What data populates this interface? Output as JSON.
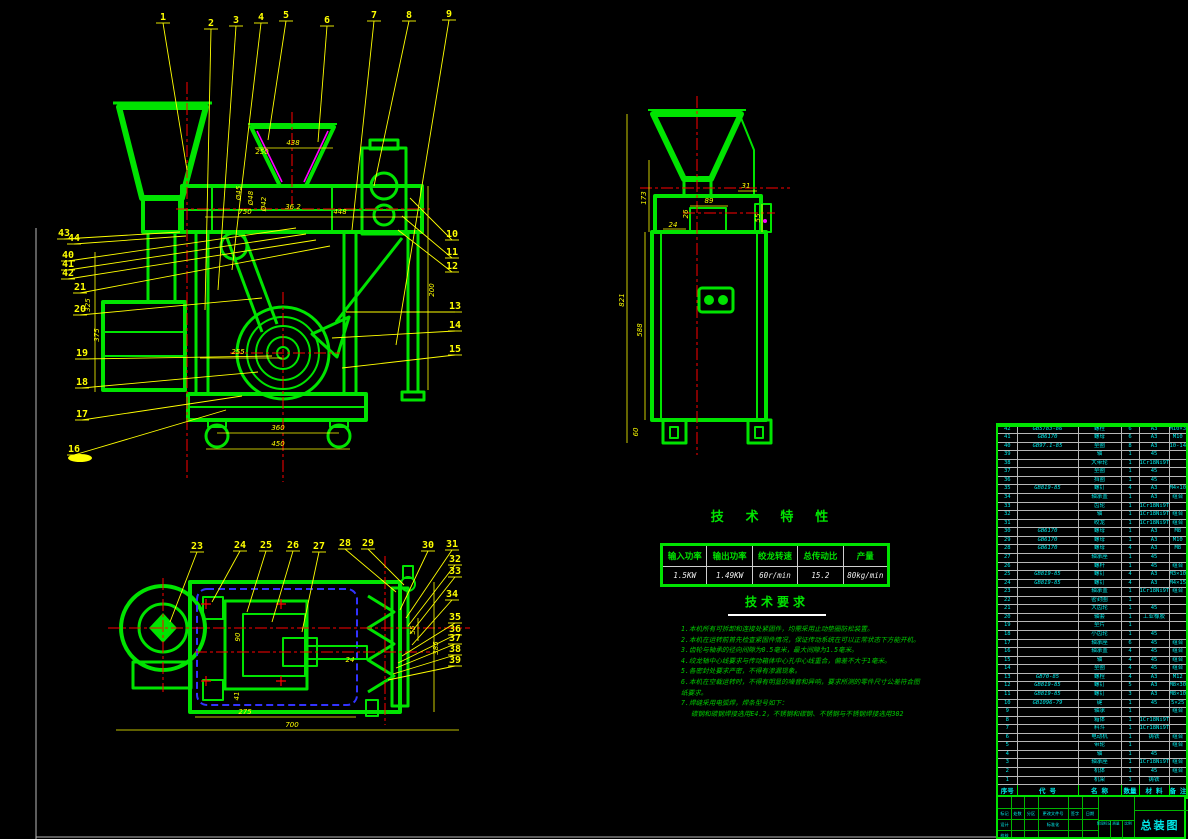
{
  "colors": {
    "line_green": "#00e400",
    "dim_yellow": "#ffff00",
    "center_red": "#ff0000",
    "hidden_blue": "#3333ff",
    "accent_magenta": "#ff00ff",
    "text_cyan": "#00e8e8",
    "grid_white": "#cfcfcf"
  },
  "drawing": {
    "callouts": [
      {
        "n": "1",
        "x": 163,
        "y": 20,
        "tx": 187,
        "ty": 170
      },
      {
        "n": "2",
        "x": 211,
        "y": 26,
        "tx": 205,
        "ty": 310
      },
      {
        "n": "3",
        "x": 236,
        "y": 23,
        "tx": 218,
        "ty": 290
      },
      {
        "n": "4",
        "x": 261,
        "y": 20,
        "tx": 232,
        "ty": 270
      },
      {
        "n": "5",
        "x": 286,
        "y": 18,
        "tx": 268,
        "ty": 140
      },
      {
        "n": "6",
        "x": 327,
        "y": 23,
        "tx": 318,
        "ty": 142
      },
      {
        "n": "7",
        "x": 374,
        "y": 18,
        "tx": 352,
        "ty": 230
      },
      {
        "n": "8",
        "x": 409,
        "y": 18,
        "tx": 374,
        "ty": 186
      },
      {
        "n": "9",
        "x": 449,
        "y": 17,
        "tx": 396,
        "ty": 345
      },
      {
        "n": "10",
        "x": 452,
        "y": 237,
        "tx": 410,
        "ty": 198
      },
      {
        "n": "11",
        "x": 452,
        "y": 255,
        "tx": 402,
        "ty": 216
      },
      {
        "n": "12",
        "x": 452,
        "y": 269,
        "tx": 398,
        "ty": 230
      },
      {
        "n": "13",
        "x": 455,
        "y": 309,
        "tx": 346,
        "ty": 312
      },
      {
        "n": "14",
        "x": 455,
        "y": 328,
        "tx": 332,
        "ty": 338
      },
      {
        "n": "15",
        "x": 455,
        "y": 352,
        "tx": 342,
        "ty": 368
      },
      {
        "n": "16",
        "x": 74,
        "y": 452,
        "tx": 226,
        "ty": 410
      },
      {
        "n": "17",
        "x": 82,
        "y": 417,
        "tx": 242,
        "ty": 396
      },
      {
        "n": "18",
        "x": 82,
        "y": 385,
        "tx": 258,
        "ty": 372
      },
      {
        "n": "19",
        "x": 82,
        "y": 356,
        "tx": 272,
        "ty": 356
      },
      {
        "n": "20",
        "x": 80,
        "y": 312,
        "tx": 262,
        "ty": 298
      },
      {
        "n": "21",
        "x": 80,
        "y": 290,
        "tx": 330,
        "ty": 246
      },
      {
        "n": "40",
        "x": 68,
        "y": 258,
        "tx": 296,
        "ty": 228
      },
      {
        "n": "41",
        "x": 68,
        "y": 267,
        "tx": 306,
        "ty": 234
      },
      {
        "n": "42",
        "x": 68,
        "y": 276,
        "tx": 316,
        "ty": 240
      },
      {
        "n": "43",
        "x": 64,
        "y": 236,
        "tx": 180,
        "ty": 232
      },
      {
        "n": "44",
        "x": 74,
        "y": 241,
        "tx": 186,
        "ty": 236
      },
      {
        "n": "23",
        "x": 197,
        "y": 549,
        "tx": 170,
        "ty": 622
      },
      {
        "n": "24",
        "x": 240,
        "y": 548,
        "tx": 212,
        "ty": 602
      },
      {
        "n": "25",
        "x": 266,
        "y": 548,
        "tx": 247,
        "ty": 612
      },
      {
        "n": "26",
        "x": 293,
        "y": 548,
        "tx": 272,
        "ty": 622
      },
      {
        "n": "27",
        "x": 319,
        "y": 549,
        "tx": 302,
        "ty": 632
      },
      {
        "n": "28",
        "x": 345,
        "y": 546,
        "tx": 396,
        "ty": 592
      },
      {
        "n": "29",
        "x": 368,
        "y": 546,
        "tx": 404,
        "ty": 585
      },
      {
        "n": "30",
        "x": 428,
        "y": 548,
        "tx": 400,
        "ty": 610
      },
      {
        "n": "31",
        "x": 452,
        "y": 547,
        "tx": 406,
        "ty": 618
      },
      {
        "n": "32",
        "x": 455,
        "y": 562,
        "tx": 408,
        "ty": 626
      },
      {
        "n": "33",
        "x": 455,
        "y": 574,
        "tx": 410,
        "ty": 634
      },
      {
        "n": "34",
        "x": 452,
        "y": 597,
        "tx": 412,
        "ty": 645
      },
      {
        "n": "35",
        "x": 455,
        "y": 620,
        "tx": 402,
        "ty": 656
      },
      {
        "n": "36",
        "x": 455,
        "y": 632,
        "tx": 398,
        "ty": 663
      },
      {
        "n": "37",
        "x": 455,
        "y": 641,
        "tx": 396,
        "ty": 668
      },
      {
        "n": "38",
        "x": 455,
        "y": 652,
        "tx": 393,
        "ty": 674
      },
      {
        "n": "39",
        "x": 455,
        "y": 663,
        "tx": 388,
        "ty": 680
      }
    ],
    "dims": {
      "front": [
        {
          "t": "438",
          "x": 293,
          "y": 145
        },
        {
          "t": "250",
          "x": 262,
          "y": 154
        },
        {
          "t": "750",
          "x": 245,
          "y": 214
        },
        {
          "t": "36.2",
          "x": 293,
          "y": 209
        },
        {
          "t": "448",
          "x": 340,
          "y": 214
        },
        {
          "t": "200",
          "x": 434,
          "y": 290,
          "r": 1
        },
        {
          "t": "255",
          "x": 238,
          "y": 354
        },
        {
          "t": "360",
          "x": 278,
          "y": 430
        },
        {
          "t": "450",
          "x": 278,
          "y": 446
        },
        {
          "t": "325",
          "x": 90,
          "y": 305,
          "r": 1
        },
        {
          "t": "375",
          "x": 99,
          "y": 335,
          "r": 1
        },
        {
          "t": "Ø45",
          "x": 241,
          "y": 193,
          "r": 1
        },
        {
          "t": "Ø48",
          "x": 253,
          "y": 198,
          "r": 1
        },
        {
          "t": "Ø42",
          "x": 266,
          "y": 204,
          "r": 1
        }
      ],
      "side": [
        {
          "t": "821",
          "x": 624,
          "y": 300,
          "r": 1
        },
        {
          "t": "588",
          "x": 642,
          "y": 330,
          "r": 1
        },
        {
          "t": "173",
          "x": 646,
          "y": 198,
          "r": 1
        },
        {
          "t": "60",
          "x": 638,
          "y": 432,
          "r": 1
        },
        {
          "t": "89",
          "x": 709,
          "y": 203
        },
        {
          "t": "31",
          "x": 746,
          "y": 188
        },
        {
          "t": "24",
          "x": 673,
          "y": 227
        },
        {
          "t": "55",
          "x": 760,
          "y": 218,
          "r": 1
        },
        {
          "t": "26",
          "x": 688,
          "y": 214,
          "r": 1
        }
      ],
      "top": [
        {
          "t": "275",
          "x": 245,
          "y": 714
        },
        {
          "t": "700",
          "x": 292,
          "y": 727
        },
        {
          "t": "385",
          "x": 438,
          "y": 648,
          "r": 1
        },
        {
          "t": "55",
          "x": 415,
          "y": 630,
          "r": 1
        },
        {
          "t": "90",
          "x": 240,
          "y": 637,
          "r": 1
        },
        {
          "t": "41",
          "x": 239,
          "y": 696,
          "r": 1
        },
        {
          "t": "24",
          "x": 350,
          "y": 662
        }
      ]
    }
  },
  "tech_table": {
    "title": "技 术 特 性",
    "headers": [
      "输入功率",
      "输出功率",
      "绞龙转速",
      "总传动比",
      "产量"
    ],
    "values": [
      "1.5KW",
      "1.49KW",
      "60r/min",
      "15.2",
      "80kg/min"
    ]
  },
  "tech_requirements": {
    "title": "技术要求",
    "lines": [
      "1.本机所有可拆卸和连接处紧固件，均需采用止动垫圈防松装置。",
      "2.本机在运转前首先检查紧固件情况，保证传动系统在可以正常状态下方能开机。",
      "3.齿轮与轴承的径向间隙为0.5毫米，最大间隙为1.5毫米。",
      "4.绞龙轴中心线要求与传动箱体中心孔中心线重合，偏差不大于1毫米。",
      "5.各密封处要求严密，不得有渗漏现象。",
      "6.本机在空载运转时，不得有明显的噪音和异响，要求所测的零件尺寸公差符合图纸要求。",
      "7.焊缝采用电弧焊，焊条型号如下：",
      "碳钢和碳钢焊接选用E4.2，不锈钢和碳钢、不锈钢与不锈钢焊接选用302"
    ]
  },
  "bom": {
    "headers": [
      "序号",
      "代 号",
      "名 称",
      "数量",
      "材 料",
      "备 注"
    ],
    "rows": [
      [
        "42",
        "GB5783-86",
        "螺栓",
        "6",
        "A3",
        "M10×30"
      ],
      [
        "41",
        "GB6170",
        "螺母",
        "6",
        "A3",
        "M10"
      ],
      [
        "40",
        "GB97.1-85",
        "垫圈",
        "8",
        "A3",
        "10-140HV"
      ],
      [
        "39",
        "",
        "轴",
        "1",
        "45",
        ""
      ],
      [
        "38",
        "",
        "大带轮",
        "1",
        "1Cr18Ni9Ti",
        ""
      ],
      [
        "37",
        "",
        "垫圈",
        "1",
        "45",
        ""
      ],
      [
        "36",
        "",
        "挡圈",
        "1",
        "45",
        ""
      ],
      [
        "35",
        "GB819-85",
        "螺钉",
        "4",
        "A3",
        "M4×10"
      ],
      [
        "34",
        "",
        "轴承盖",
        "1",
        "A3",
        "组合"
      ],
      [
        "33",
        "",
        "齿轮",
        "1",
        "1Cr18Ni9Ti",
        ""
      ],
      [
        "32",
        "",
        "轴",
        "1",
        "1Cr18Ni9Ti",
        "组合"
      ],
      [
        "31",
        "",
        "绞龙",
        "1",
        "1Cr18Ni9Ti",
        "组合"
      ],
      [
        "30",
        "GB6170",
        "螺母",
        "1",
        "A3",
        "M8"
      ],
      [
        "29",
        "GB6170",
        "螺母",
        "1",
        "A3",
        "M10"
      ],
      [
        "28",
        "GB6170",
        "螺母",
        "4",
        "A3",
        "M8"
      ],
      [
        "27",
        "",
        "轴承座",
        "1",
        "45",
        ""
      ],
      [
        "26",
        "",
        "螺杆",
        "1",
        "45",
        "组合"
      ],
      [
        "25",
        "GB819-85",
        "螺钉",
        "4",
        "A3",
        "M3×10"
      ],
      [
        "24",
        "GB819-85",
        "螺钉",
        "4",
        "A3",
        "M4×15"
      ],
      [
        "23",
        "",
        "轴承盖",
        "1",
        "1Cr18Ni9Ti",
        "组合"
      ],
      [
        "22",
        "",
        "密封圈",
        "1",
        "",
        ""
      ],
      [
        "21",
        "",
        "大齿轮",
        "1",
        "45",
        ""
      ],
      [
        "20",
        "",
        "轴套",
        "1",
        "工业橡胶",
        ""
      ],
      [
        "19",
        "",
        "垫片",
        "1",
        "",
        ""
      ],
      [
        "18",
        "",
        "小齿轮",
        "1",
        "45",
        ""
      ],
      [
        "17",
        "",
        "轴承座",
        "6",
        "45",
        "组合"
      ],
      [
        "16",
        "",
        "轴承盖",
        "4",
        "45",
        "组合"
      ],
      [
        "15",
        "",
        "轴",
        "4",
        "45",
        "组合"
      ],
      [
        "14",
        "",
        "垫圈",
        "4",
        "45",
        "组合"
      ],
      [
        "13",
        "GB70-85",
        "螺栓",
        "4",
        "A3",
        "M12"
      ],
      [
        "12",
        "GB819-85",
        "螺钉",
        "5",
        "A3",
        "M8×30"
      ],
      [
        "11",
        "GB819-85",
        "螺钉",
        "3",
        "A3",
        "M8×10"
      ],
      [
        "10",
        "GB1096-79",
        "键",
        "1",
        "45",
        "5×25"
      ],
      [
        "9",
        "",
        "轴承",
        "1",
        "",
        "组合"
      ],
      [
        "8",
        "",
        "箱体",
        "1",
        "1Cr18Ni9Ti",
        ""
      ],
      [
        "7",
        "",
        "料斗",
        "1",
        "1Cr18Ni9Ti",
        ""
      ],
      [
        "6",
        "",
        "电动机",
        "1",
        "铸铁",
        "组合"
      ],
      [
        "5",
        "",
        "带轮",
        "1",
        "",
        "组合"
      ],
      [
        "4",
        "",
        "轴",
        "1",
        "45",
        ""
      ],
      [
        "3",
        "",
        "轴承座",
        "1",
        "1Cr18Ni9Ti",
        "组合"
      ],
      [
        "2",
        "",
        "机体",
        "1",
        "45",
        "组合"
      ],
      [
        "1",
        "",
        "机架",
        "1",
        "铸铁",
        ""
      ]
    ]
  },
  "title_block": {
    "title": "总装图",
    "cells": [
      {
        "t": "标记",
        "x": 6.5,
        "y": 16.5
      },
      {
        "t": "处数",
        "x": 19.5,
        "y": 16.5
      },
      {
        "t": "分区",
        "x": 33,
        "y": 16.5
      },
      {
        "t": "更改文件号",
        "x": 55,
        "y": 16.5
      },
      {
        "t": "签字",
        "x": 77,
        "y": 16.5
      },
      {
        "t": "日期",
        "x": 92,
        "y": 16.5
      },
      {
        "t": "设计",
        "x": 6.5,
        "y": 27.5
      },
      {
        "t": "标准化",
        "x": 55,
        "y": 27.5
      },
      {
        "t": "校核",
        "x": 6.5,
        "y": 38.5
      },
      {
        "t": "阶段标记",
        "x": 106,
        "y": 27,
        "s": 3.6
      },
      {
        "t": "质量",
        "x": 118,
        "y": 27,
        "s": 3.6
      },
      {
        "t": "比例",
        "x": 130,
        "y": 27,
        "s": 3.6
      }
    ]
  }
}
